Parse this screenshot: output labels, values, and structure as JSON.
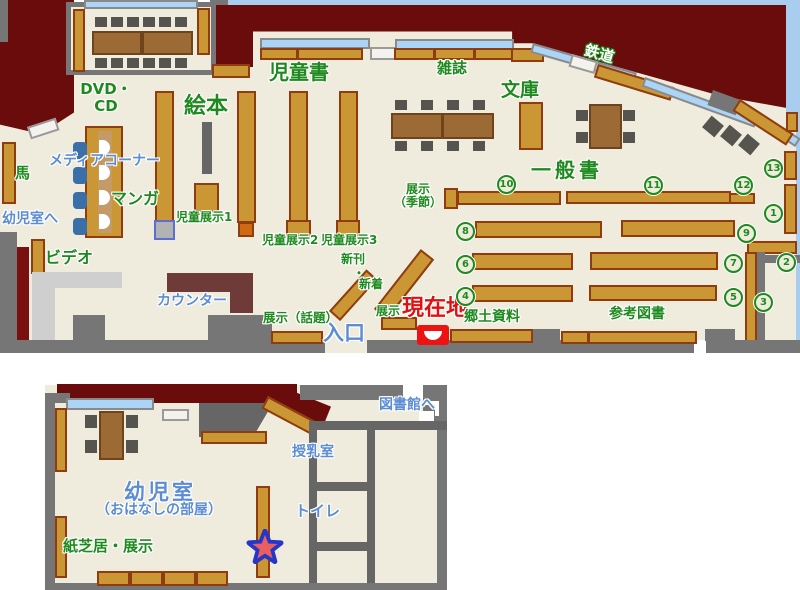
{
  "labels": {
    "children_books": "児童書",
    "magazines": "雑誌",
    "paperbacks": "文庫",
    "railway": "鉄道",
    "picture_books": "絵本",
    "dvd_cd": "DVD・\nCD",
    "media_corner": "メディアコーナー",
    "manga": "マンガ",
    "horse": "馬",
    "to_infant_room": "幼児室へ",
    "video": "ビデオ",
    "counter": "カウンター",
    "child_display1": "児童展示1",
    "child_display2": "児童展示2",
    "child_display3": "児童展示3",
    "new_arrivals_1": "新刊",
    "new_arrivals_dot": "・",
    "new_arrivals_2": "新着",
    "display_topics": "展示（話題）",
    "display_small": "展示",
    "entrance": "入口",
    "current_location": "現在地",
    "local_materials": "郷土資料",
    "reference_books": "参考図書",
    "general_books": "一般書",
    "display_seasonal": "展示\n（季節）",
    "to_library": "図書館へ",
    "nursing_room": "授乳室",
    "toilet": "トイレ",
    "infant_room": "幼児室",
    "infant_room_sub": "（おはなしの部屋）",
    "kamishibai_display": "紙芝居・展示"
  },
  "numbers": {
    "n1": "1",
    "n2": "2",
    "n3": "3",
    "n4": "4",
    "n5": "5",
    "n6": "6",
    "n7": "7",
    "n8": "8",
    "n9": "9",
    "n10": "10",
    "n11": "11",
    "n12": "12",
    "n13": "13"
  },
  "colors": {
    "floor": "#efecdd",
    "wall_gray": "#767676",
    "wall_maroon": "#6a0c0c",
    "shelf_orange": "#cb9634",
    "shelf_border": "#8e3c10",
    "window_blue": "#abd4f6",
    "sky_blue": "#a8cdef",
    "green_text": "#1e8a1e",
    "blue_text": "#5b8cd4",
    "red_text": "#dd1111",
    "marker_red": "#ee1212",
    "star_blue": "#2637c8",
    "star_red": "#ea5f5f"
  }
}
